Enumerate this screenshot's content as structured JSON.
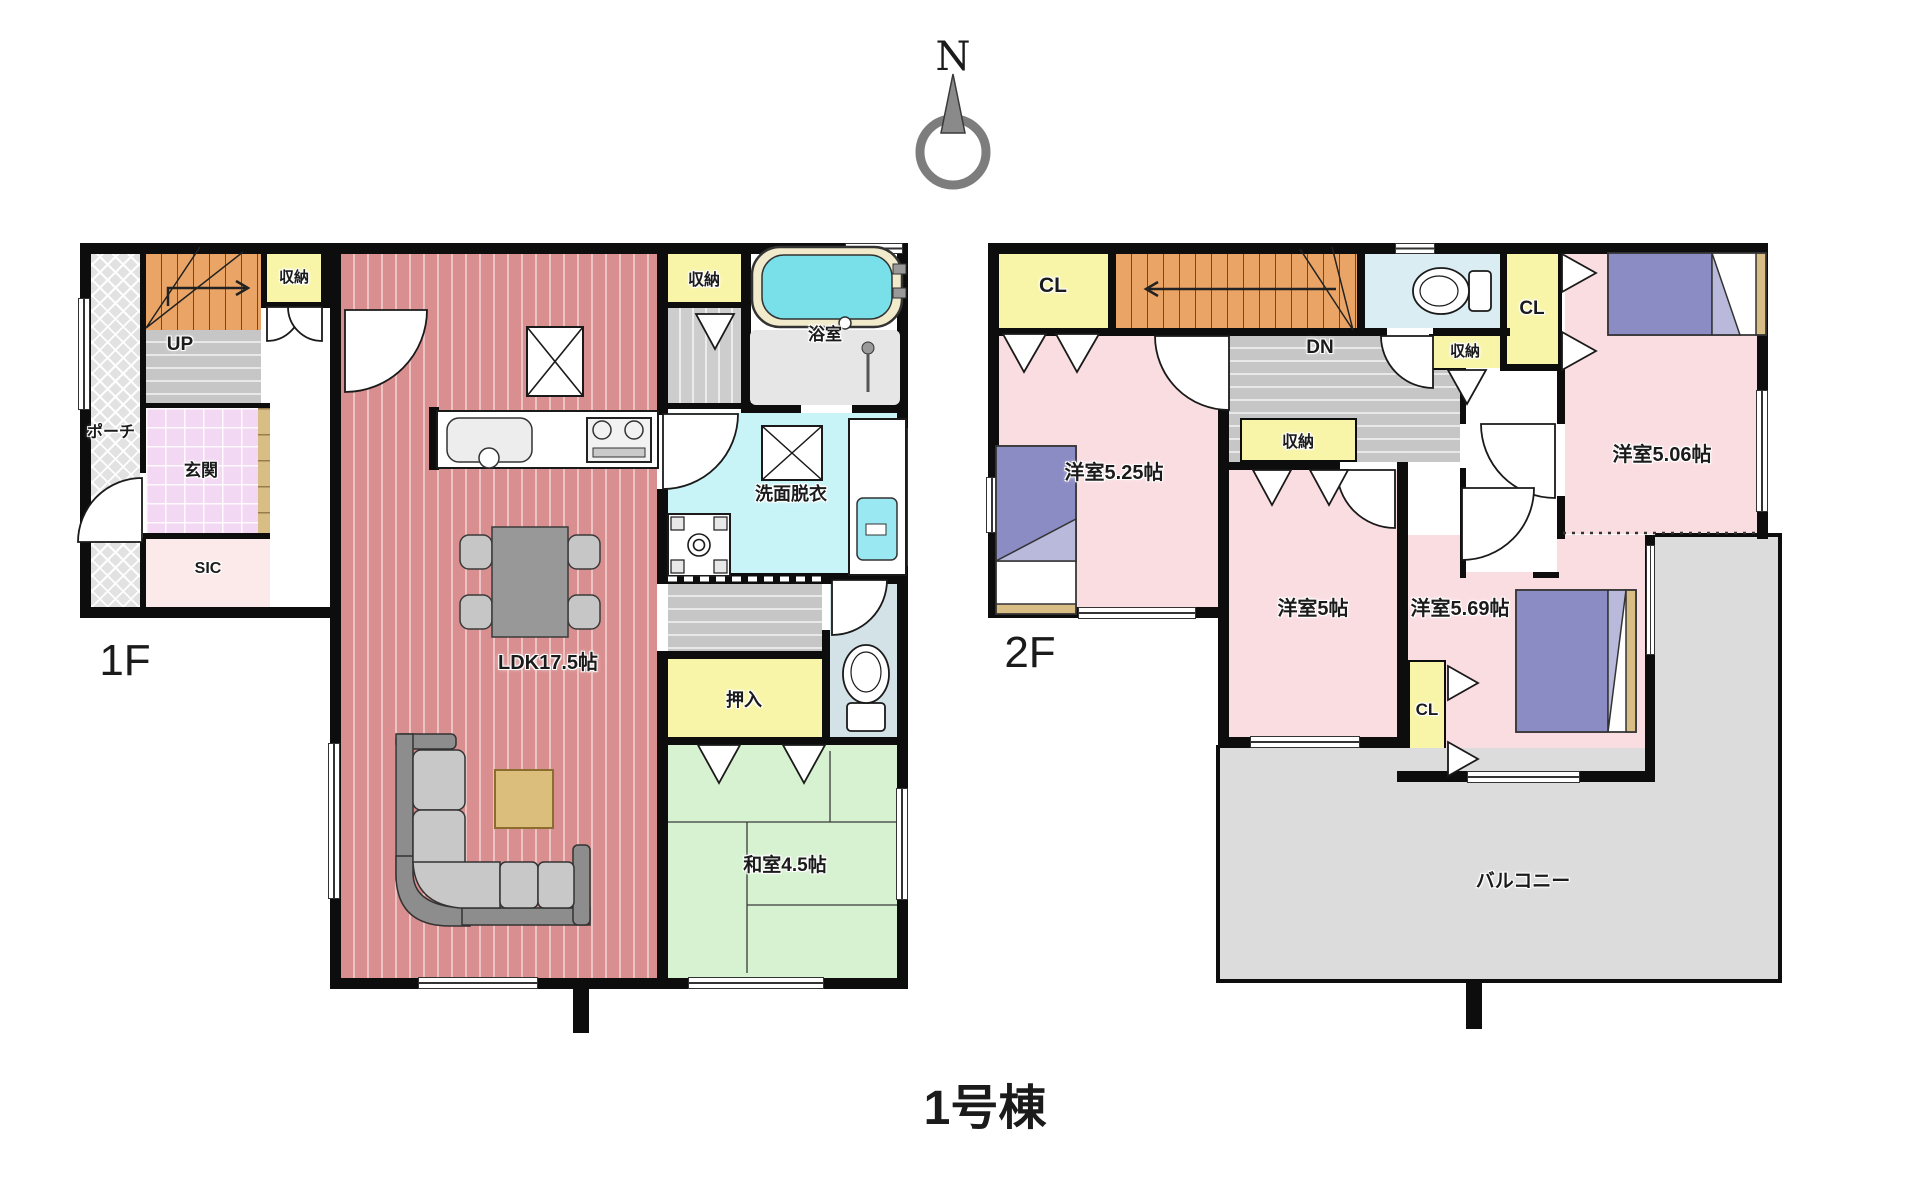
{
  "title": "1号棟",
  "compass": {
    "north": "N"
  },
  "floor1": {
    "label": "1F",
    "rooms": {
      "porch": "ポーチ",
      "up": "UP",
      "entry": "玄関",
      "sic": "SIC",
      "storage_a": "収納",
      "storage_b": "収納",
      "bath": "浴室",
      "washroom": "洗面脱衣",
      "ldk": "LDK17.5帖",
      "oshiire": "押入",
      "washitsu": "和室4.5帖"
    }
  },
  "floor2": {
    "label": "2F",
    "rooms": {
      "cl_a": "CL",
      "dn": "DN",
      "storage_a": "収納",
      "cl_b": "CL",
      "room_525": "洋室5.25帖",
      "room_5": "洋室5帖",
      "room_506": "洋室5.06帖",
      "room_569": "洋室5.69帖",
      "storage_b": "収納",
      "cl_c": "CL",
      "balcony": "バルコニー"
    }
  },
  "colors": {
    "wall": "#0d0d0d",
    "ldk_red": "#d98f8f",
    "closet_yellow": "#f8f5a8",
    "stairs_orange": "#eaa566",
    "tatami_green": "#d6f2d0",
    "washroom_cyan": "#c9f4f7",
    "bedroom_pink": "#fadde1",
    "bed_purple": "#8c8cc4",
    "balcony_gray": "#dcdcdc"
  }
}
